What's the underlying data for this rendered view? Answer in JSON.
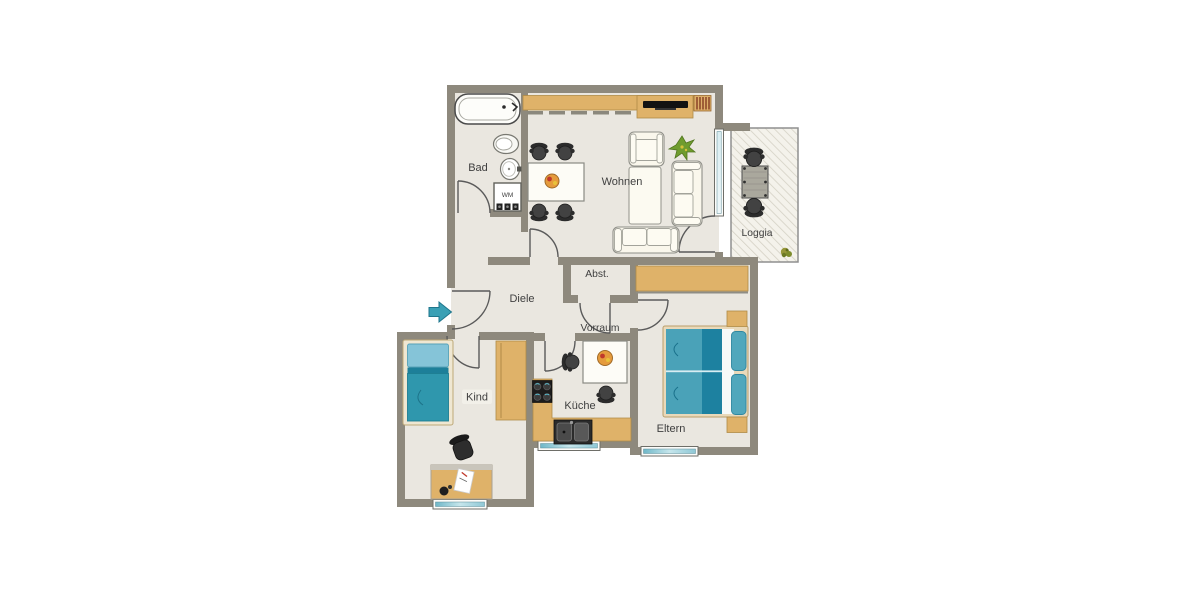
{
  "floorplan": {
    "rooms": {
      "bad": {
        "label": "Bad"
      },
      "wohnen": {
        "label": "Wohnen"
      },
      "loggia": {
        "label": "Loggia"
      },
      "diele": {
        "label": "Diele"
      },
      "abstellraum": {
        "label": "Abst."
      },
      "vorraum": {
        "label": "Vorraum"
      },
      "kueche": {
        "label": "Küche"
      },
      "kind": {
        "label": "Kind"
      },
      "eltern": {
        "label": "Eltern"
      }
    },
    "labels": {
      "washing_machine": "WM"
    },
    "icons": {
      "entrance": "entrance-arrow"
    },
    "colors": {
      "wall": "#8e897d",
      "floor": "#eae7e0",
      "tan": "#dfb269",
      "tan_border": "#b08b47",
      "teal": "#3b9fb2",
      "teal_dark": "#1d81a0",
      "teal_light": "#85c4d8",
      "glass": "#8fc8d6",
      "cream": "#faf7ec",
      "furniture_dark": "#3a3a3a",
      "line": "#5a5a5a",
      "label_color": "#3f3f3f",
      "plant": "#6f9c2e",
      "background": "#ffffff"
    }
  }
}
